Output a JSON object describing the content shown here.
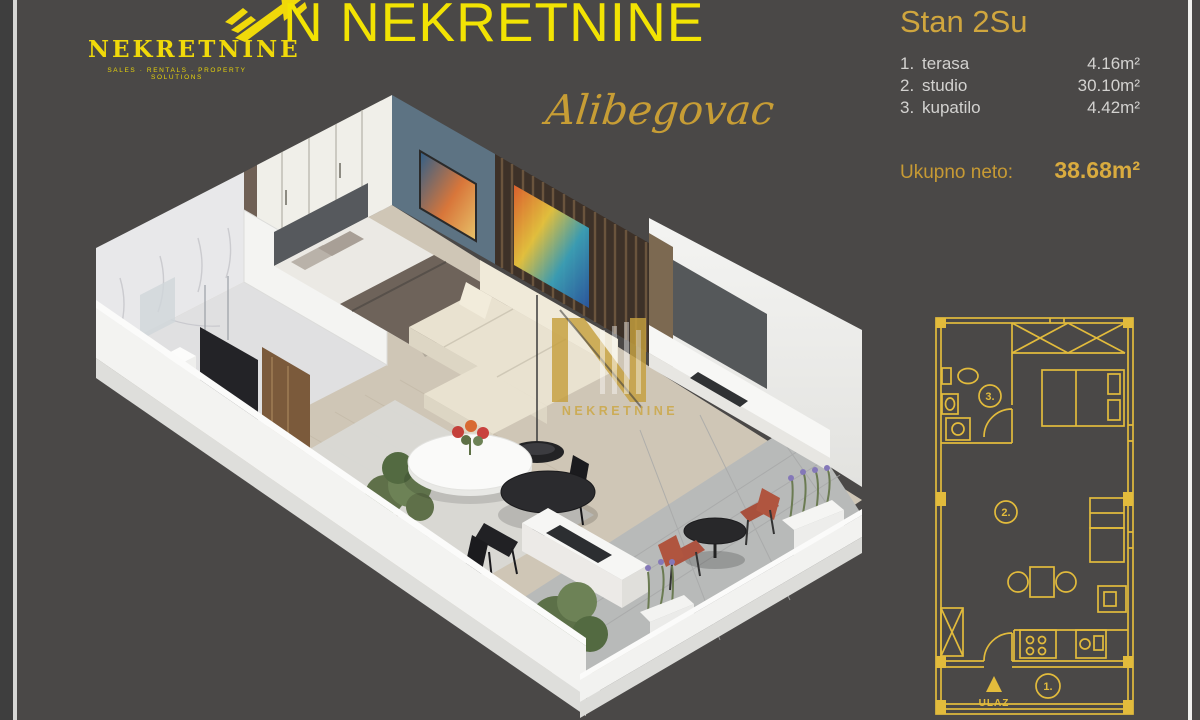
{
  "brand": {
    "logo_text": "NEKRETNINE",
    "tagline": "SALES · RENTALS · PROPERTY SOLUTIONS",
    "title": "N NEKRETNINE",
    "watermark": "NEKRETNINE"
  },
  "project": {
    "name": "Alibegovac"
  },
  "apartment": {
    "name": "Stan 2Su",
    "rooms": [
      {
        "num": "1.",
        "label": "terasa",
        "area": "4.16m²"
      },
      {
        "num": "2.",
        "label": "studio",
        "area": "30.10m²"
      },
      {
        "num": "3.",
        "label": "kupatilo",
        "area": "4.42m²"
      }
    ],
    "total_label": "Ukupno neto:",
    "total_value": "38.68m²"
  },
  "floor_plan": {
    "labels": {
      "bathroom": "3.",
      "studio": "2.",
      "terrace": "1.",
      "entrance": "ULAZ"
    }
  },
  "icons": {
    "entrance_arrow": "▲",
    "logo_mark": "winged-N"
  },
  "colors": {
    "background": "#4a4847",
    "bright_yellow": "#f2e303",
    "gold": "#c9a23a",
    "plan_yellow": "#e2bb3c",
    "list_text": "#d3d2d0"
  }
}
